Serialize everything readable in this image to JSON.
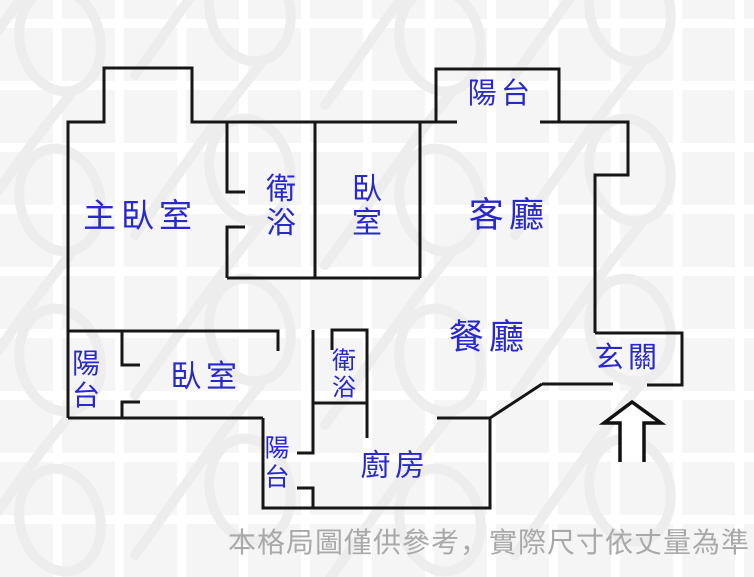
{
  "drawing": {
    "type": "apartment-floor-plan",
    "colors": {
      "wall": "#161616",
      "room_label": "#2828cc",
      "disclaimer_text": "#a9a9a9",
      "background_square": "#f5f5f6",
      "grid_gutter": "#ffffff",
      "watermark": "#ededed"
    },
    "rooms": [
      {
        "id": "balcony-top",
        "label": "陽台"
      },
      {
        "id": "master-bedroom",
        "label": "主臥室"
      },
      {
        "id": "bathroom-master",
        "label": "衛浴"
      },
      {
        "id": "bedroom-middle",
        "label": "臥室"
      },
      {
        "id": "living-room",
        "label": "客廳"
      },
      {
        "id": "dining-room",
        "label": "餐廳"
      },
      {
        "id": "entryway",
        "label": "玄關"
      },
      {
        "id": "balcony-left",
        "label": "陽台"
      },
      {
        "id": "bedroom-lower",
        "label": "臥室"
      },
      {
        "id": "bathroom-small",
        "label": "衛浴"
      },
      {
        "id": "balcony-bottom",
        "label": "陽台"
      },
      {
        "id": "kitchen",
        "label": "廚房"
      }
    ],
    "entrance_arrow": {
      "direction": "up",
      "meaning": "main entrance at 玄關"
    },
    "disclaimer": "本格局圖僅供參考，實際尺寸依丈量為準"
  }
}
